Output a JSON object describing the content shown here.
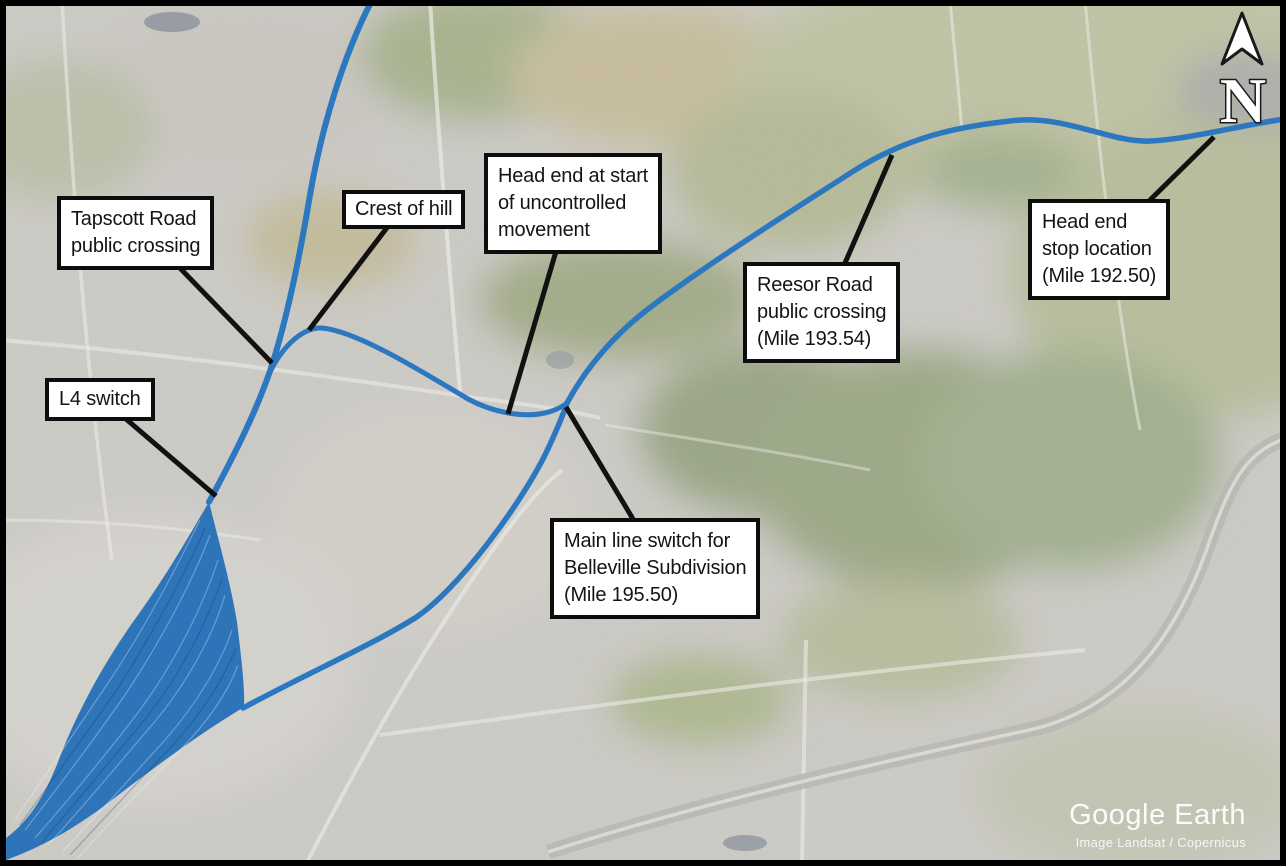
{
  "figure": {
    "kind": "annotated-satellite-map",
    "compass": {
      "label": "N"
    },
    "attribution": {
      "brand": "Google Earth",
      "credit": "Image Landsat / Copernicus"
    },
    "callouts": [
      {
        "id": "tapscott-road-crossing",
        "text": "Tapscott Road\npublic crossing"
      },
      {
        "id": "crest-of-hill",
        "text": "Crest of hill"
      },
      {
        "id": "head-end-start",
        "text": "Head end at start\nof uncontrolled\nmovement"
      },
      {
        "id": "reesor-road-crossing",
        "text": "Reesor Road\npublic crossing\n(Mile 193.54)"
      },
      {
        "id": "head-end-stop",
        "text": "Head end\nstop location\n(Mile 192.50)"
      },
      {
        "id": "l4-switch",
        "text": "L4 switch"
      },
      {
        "id": "belleville-main-line-switch",
        "text": "Main line switch for\nBelleville Subdivision\n(Mile 195.50)"
      }
    ],
    "colors": {
      "route_blue": "#2b77c0",
      "yard_fill": "#2d74b9",
      "leader_black": "#111111",
      "callout_background": "#ffffff",
      "callout_border": "#0d0d0d",
      "frame": "#000000"
    }
  }
}
